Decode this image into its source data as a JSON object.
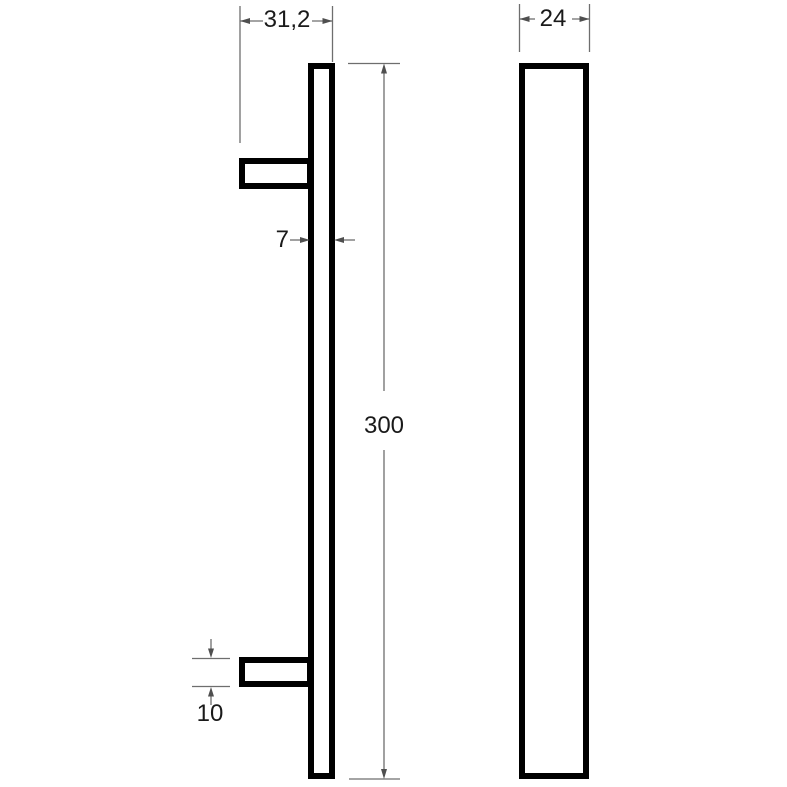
{
  "diagram": {
    "dimensions": {
      "overall_depth": "31,2",
      "bar_thickness": "7",
      "length": "300",
      "standoff_height": "10",
      "profile_width": "24"
    },
    "colors": {
      "outline": "#000000",
      "background": "#ffffff",
      "dim_line": "#6e6e6e",
      "arrowhead": "#4f4f4f",
      "label": "#1a1a1a"
    }
  }
}
